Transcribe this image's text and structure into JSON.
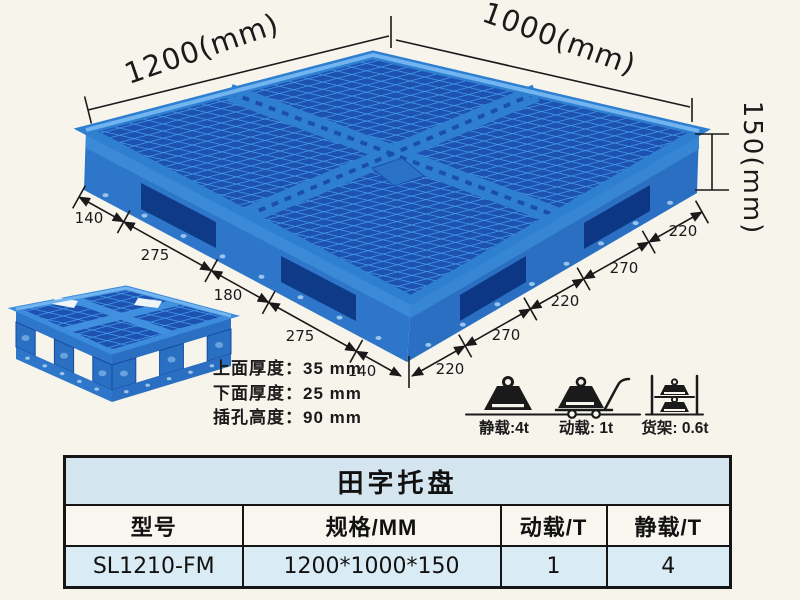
{
  "page": {
    "background": "#f7f4ec",
    "annotation_color": "#1a1a1a"
  },
  "pallet": {
    "colors": {
      "blue_main": "#2f7fd1",
      "blue_grid_dark": "#1d52b2",
      "blue_deep_opening": "#0f3a88",
      "blue_highlight": "#72b4ef",
      "blue_wall": "#2d76c9"
    },
    "dims": {
      "width_label": "1200(mm)",
      "depth_label": "1000(mm)",
      "height_label": "150(mm)",
      "left_chain": [
        "140",
        "275",
        "180",
        "275",
        "140"
      ],
      "right_chain": [
        "220",
        "270",
        "220",
        "270",
        "220"
      ]
    },
    "spec_lines": [
      "上面厚度：35 mm",
      "下面厚度：25 mm",
      "插孔高度：90 mm"
    ],
    "load_icons": [
      {
        "name": "static-load-icon",
        "label": "静载:4t"
      },
      {
        "name": "dynamic-load-icon",
        "label": "动载: 1t"
      },
      {
        "name": "rack-load-icon",
        "label": "货架: 0.6t"
      }
    ]
  },
  "table": {
    "title": "田字托盘",
    "headers": [
      "型号",
      "规格/MM",
      "动载/T",
      "静载/T"
    ],
    "rows": [
      [
        "SL1210-FM",
        "1200*1000*150",
        "1",
        "4"
      ]
    ],
    "title_bg": "#d5e5ef",
    "row_bg": "#d9ebf5"
  }
}
